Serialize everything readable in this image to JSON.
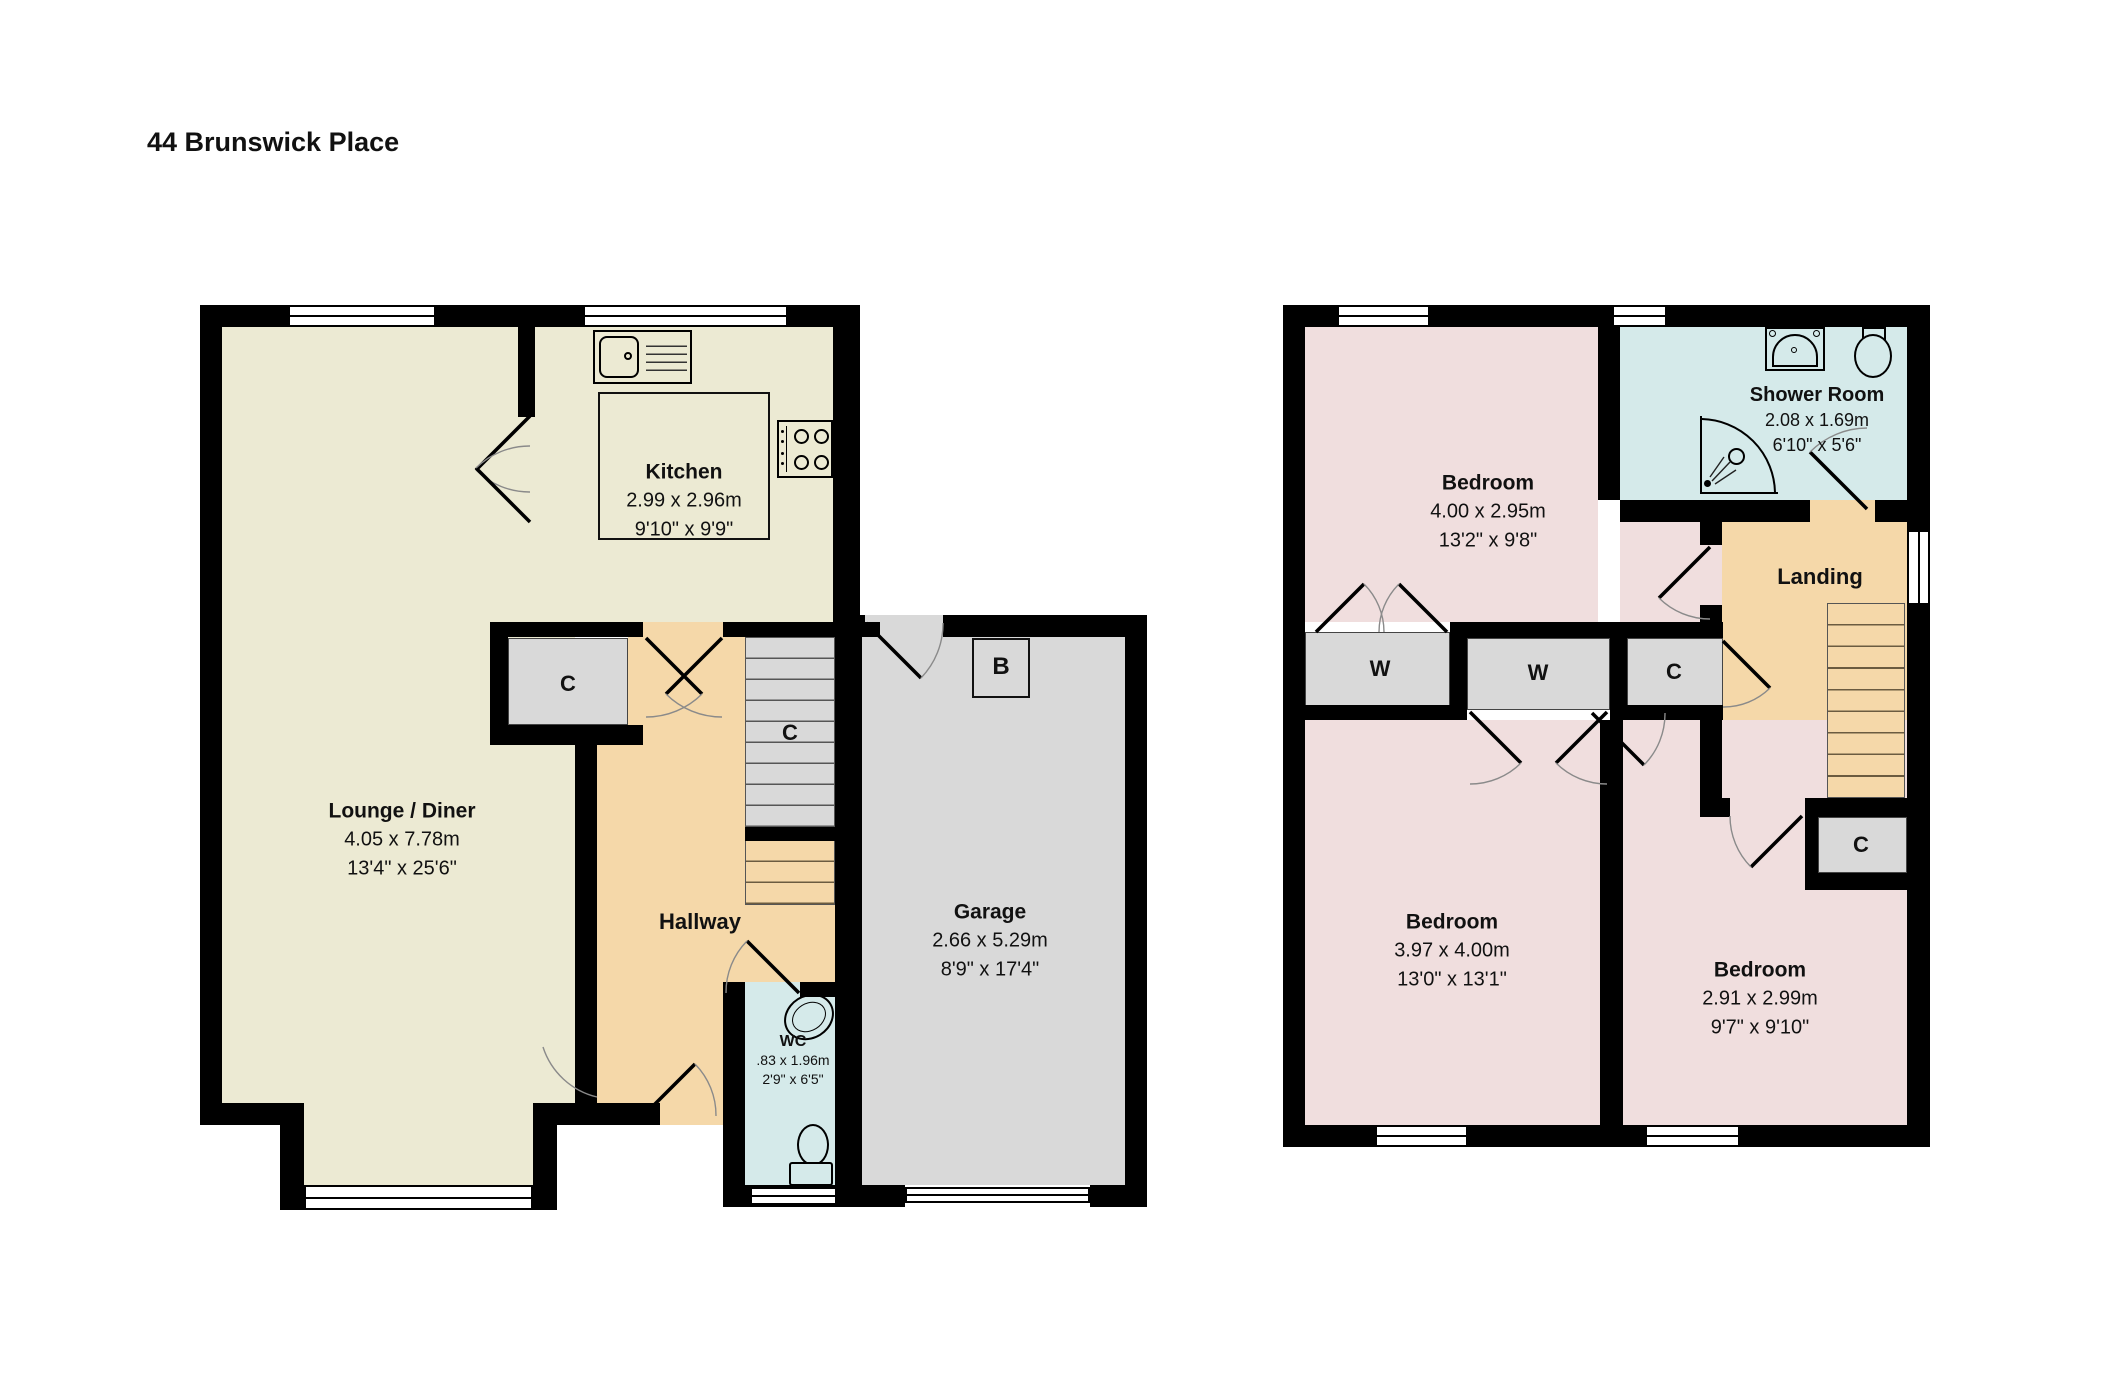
{
  "title": "44 Brunswick Place",
  "ground_floor": {
    "lounge": {
      "name": "Lounge / Diner",
      "metric": "4.05 x 7.78m",
      "imperial": "13'4\" x 25'6\""
    },
    "kitchen": {
      "name": "Kitchen",
      "metric": "2.99 x 2.96m",
      "imperial": "9'10\" x 9'9\""
    },
    "hallway": {
      "name": "Hallway"
    },
    "wc": {
      "name": "WC",
      "metric": ".83 x 1.96m",
      "imperial": "2'9\" x 6'5\""
    },
    "garage": {
      "name": "Garage",
      "metric": "2.66 x 5.29m",
      "imperial": "8'9\" x 17'4\""
    },
    "cupboard_label": "C",
    "stairs_cupboard_label": "C",
    "boiler_label": "B"
  },
  "first_floor": {
    "bedroom_front": {
      "name": "Bedroom",
      "metric": "4.00 x 2.95m",
      "imperial": "13'2\" x 9'8\""
    },
    "shower_room": {
      "name": "Shower Room",
      "metric": "2.08 x 1.69m",
      "imperial": "6'10\" x 5'6\""
    },
    "landing": {
      "name": "Landing"
    },
    "bedroom_left": {
      "name": "Bedroom",
      "metric": "3.97 x 4.00m",
      "imperial": "13'0\" x 13'1\""
    },
    "bedroom_right": {
      "name": "Bedroom",
      "metric": "2.91 x 2.99m",
      "imperial": "9'7\" x 9'10\""
    },
    "wardrobe1_label": "W",
    "wardrobe2_label": "W",
    "cupboard_mid_label": "C",
    "cupboard_right_label": "C"
  },
  "colors": {
    "wall": "#000000",
    "cream": "#ECEAD3",
    "tan": "#F5D8A9",
    "gray": "#D9D9D9",
    "pink": "#F0DEDE",
    "blue": "#D5EAEA"
  }
}
